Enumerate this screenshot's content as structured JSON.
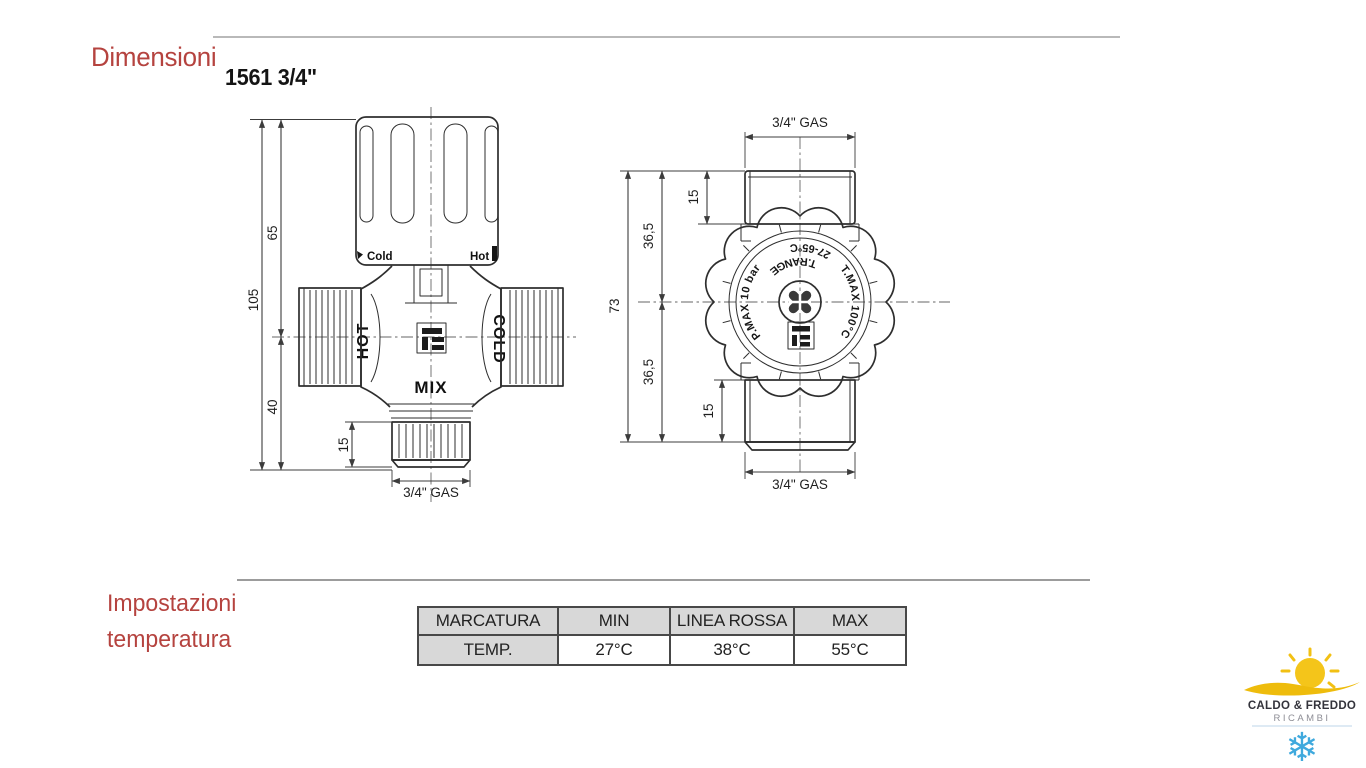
{
  "page": {
    "title": "Dimensioni",
    "product_code": "1561 3/4\"",
    "section2_line1": "Impostazioni",
    "section2_line2": "temperatura"
  },
  "colors": {
    "heading_red": "#b5433f",
    "rule_gray": "#b9b9b9",
    "drawing_line": "#2e2e2e",
    "table_header_bg": "#d8d8d8",
    "logo_yellow": "#f2c013",
    "logo_blue": "#3fa9dd"
  },
  "front_view": {
    "knob_labels": {
      "cold": "Cold",
      "hot": "Hot"
    },
    "body_labels": {
      "hot_port": "HOT",
      "cold_port": "COLD",
      "mix": "MIX"
    },
    "dimensions": {
      "height_total": "105",
      "height_upper": "65",
      "height_lower": "40",
      "thread_length": "15",
      "thread_size": "3/4\" GAS"
    }
  },
  "top_view": {
    "dimensions": {
      "top_thread_size": "3/4\" GAS",
      "top_thread_length": "15",
      "upper_half": "36,5",
      "total": "73",
      "lower_half": "36,5",
      "bottom_thread_length": "15",
      "bottom_thread_size": "3/4\" GAS"
    },
    "knob_ring_text": {
      "left": "P.MAX 10 bar",
      "top_inner": "T.RANGE",
      "top_outer": "27-65°C",
      "right": "T.MAX 100°C"
    }
  },
  "table": {
    "headers": [
      "MARCATURA",
      "MIN",
      "LINEA ROSSA",
      "MAX"
    ],
    "rows": [
      [
        "TEMP.",
        "27°C",
        "38°C",
        "55°C"
      ]
    ]
  },
  "logo": {
    "line1": "CALDO & FREDDO",
    "line2": "RICAMBI",
    "snowflake": "❄"
  }
}
